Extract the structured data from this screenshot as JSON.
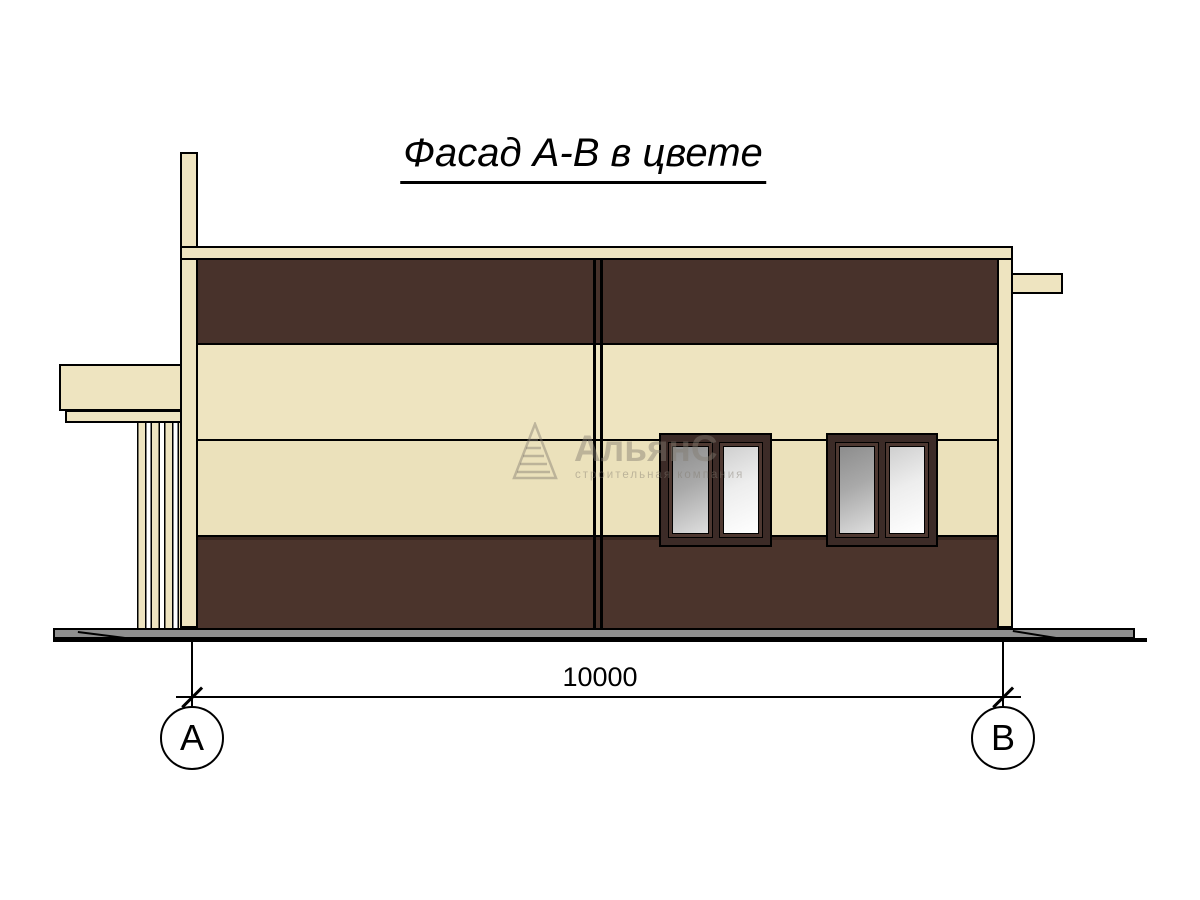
{
  "title": {
    "text": "Фасад А-В в цвете"
  },
  "dimension": {
    "value": "10000"
  },
  "axes": {
    "a": "А",
    "b": "В"
  },
  "watermark": {
    "brand": "АльянС",
    "tagline": "строительная компания",
    "logo": "pyramid-icon"
  },
  "colors": {
    "cream": "#EEE4C0",
    "cream_dark": "#EBE1BB",
    "brown_top": "#48322B",
    "brown_bottom": "#4B342C",
    "window_frame": "#3C2B27",
    "window_sash": "#4E3831",
    "ground": "#8F8F8F",
    "outline": "#000000"
  }
}
